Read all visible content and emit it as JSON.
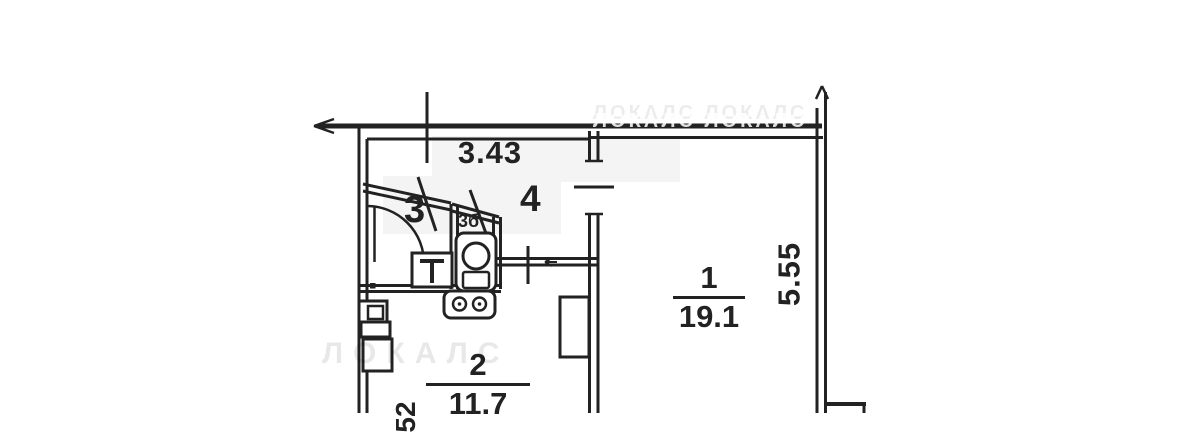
{
  "colors": {
    "ink": "#222222",
    "paper": "#ffffff",
    "patch": "#f4f4f4",
    "watermark": "#bfbfbf"
  },
  "dimensions": {
    "top_width": "3.43",
    "right_height": "5.55",
    "bottom_left_partial": "52"
  },
  "rooms": {
    "room1": {
      "number": "1",
      "area": "19.1"
    },
    "room2": {
      "number": "2",
      "area": "11.7"
    },
    "room3": {
      "number": "3"
    },
    "room3b": {
      "number": "3б"
    },
    "room4": {
      "number": "4"
    }
  },
  "watermark": {
    "tile_text": "ЛОКАЛС",
    "top_row": "ЛОКАЛС ЛОКАЛС"
  },
  "fixtures": [
    "door-arc",
    "washbasin",
    "toilet",
    "stove",
    "kitchen-sink",
    "kitchen-counter",
    "kitchen-cabinet",
    "wardrobe"
  ]
}
